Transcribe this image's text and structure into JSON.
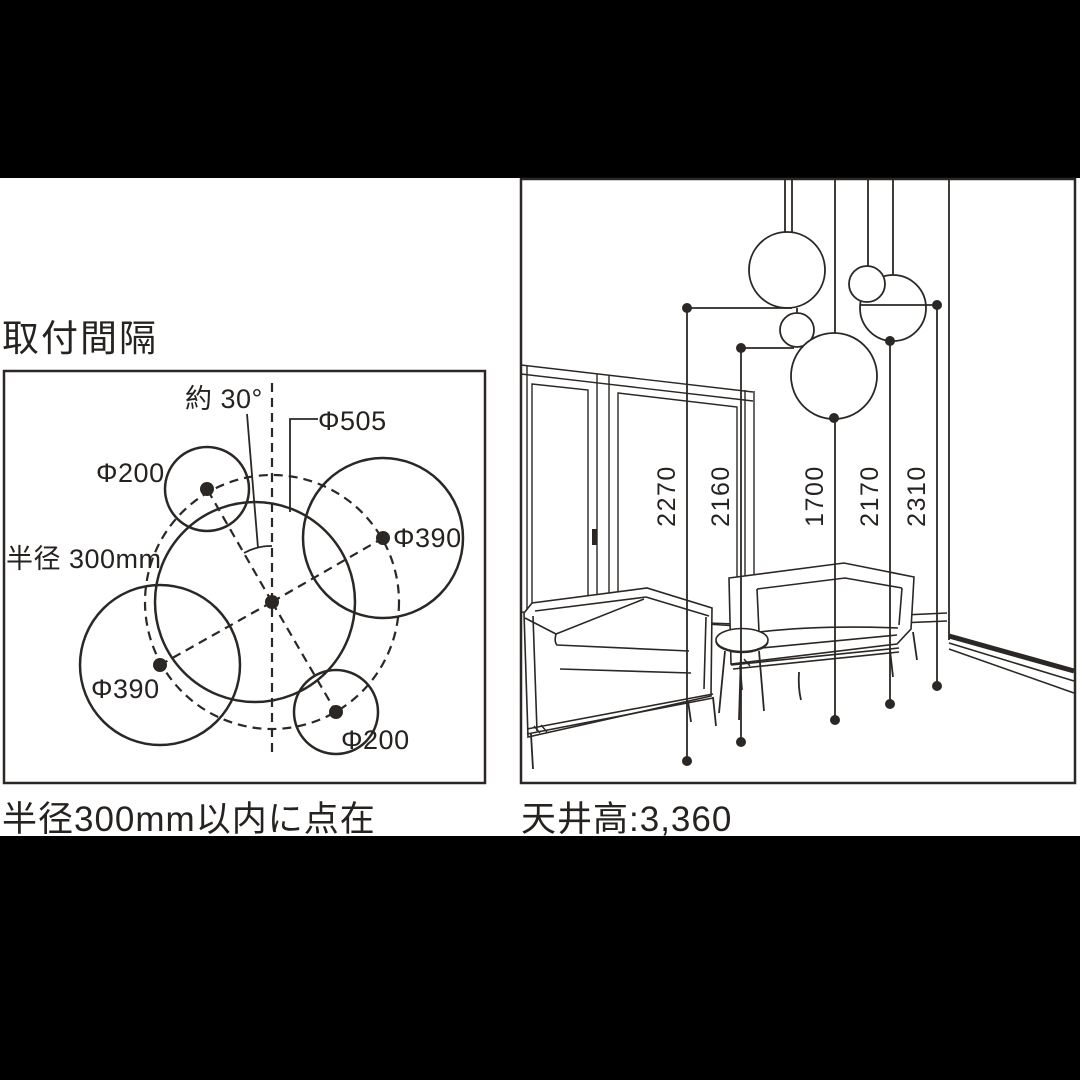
{
  "page": {
    "background_color": "#000000",
    "panel_color": "#ffffff",
    "line_color": "#2b2724"
  },
  "left_panel": {
    "title": "取付間隔",
    "caption": "半径300mm以内に点在",
    "labels": {
      "angle": "約 30°",
      "dia_505": "Φ505",
      "dia_200_top": "Φ200",
      "dia_390_right": "Φ390",
      "radius": "半径 300mm",
      "dia_390_left": "Φ390",
      "dia_200_bottom": "Φ200"
    }
  },
  "right_panel": {
    "caption": "天井高:3,360",
    "dimensions": [
      "2270",
      "2160",
      "1700",
      "2170",
      "2310"
    ]
  }
}
